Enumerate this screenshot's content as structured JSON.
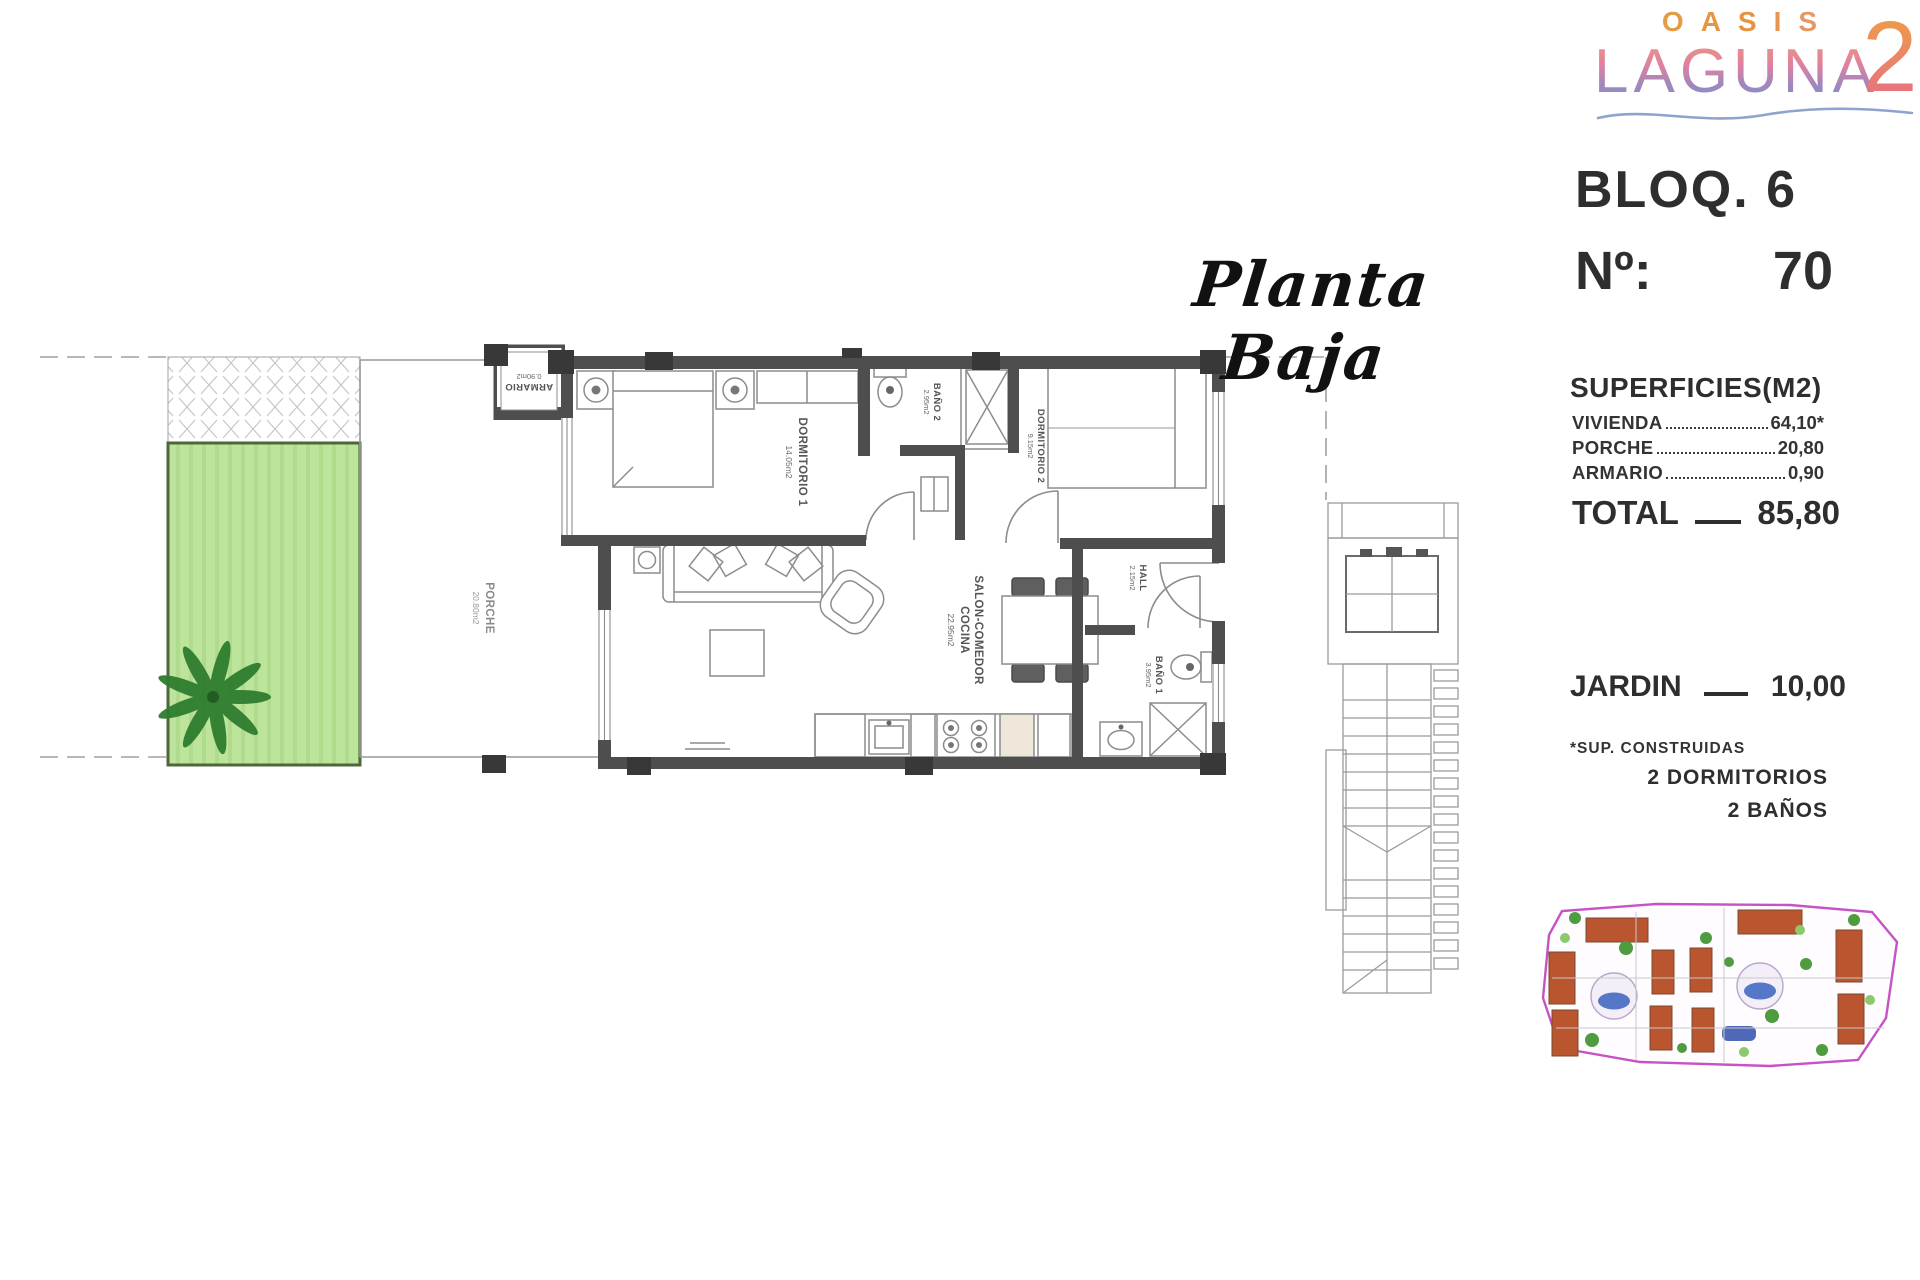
{
  "logo": {
    "brand_top": "OASIS",
    "brand_main": "LAGUNA",
    "brand_numeral": "2"
  },
  "plan_title": "Planta Baja",
  "unit_info": {
    "block": "BLOQ. 6",
    "number_prefix": "Nº:",
    "number": "70"
  },
  "surfaces": {
    "title": "SUPERFICIES(M2)",
    "rows": [
      {
        "label": "VIVIENDA",
        "value": "64,10*"
      },
      {
        "label": "PORCHE",
        "value": "20,80"
      },
      {
        "label": "ARMARIO",
        "value": "0,90"
      }
    ],
    "total_label": "TOTAL",
    "total_value": "85,80",
    "jardin_label": "JARDIN",
    "jardin_value": "10,00",
    "footnote": "*SUP. CONSTRUIDAS",
    "features": [
      "2 DORMITORIOS",
      "2 BAÑOS"
    ]
  },
  "rooms": {
    "dormitorio1": {
      "name": "DORMITORIO 1",
      "area": "14.05m2"
    },
    "bano2": {
      "name": "BAÑO 2",
      "area": "2.95m2"
    },
    "dormitorio2": {
      "name": "DORMITORIO 2",
      "area": "9.15m2"
    },
    "salon": {
      "line1": "SALON-COMEDOR",
      "line2": "COCINA",
      "area": "22.95m2"
    },
    "hall": {
      "name": "HALL",
      "area": "2.15m2"
    },
    "bano1": {
      "name": "BAÑO 1",
      "area": "3.95m2"
    },
    "porche": {
      "name": "PORCHE",
      "area": "20.80m2"
    },
    "armario": {
      "name": "ARMARIO",
      "area": "0.90m2"
    }
  },
  "colors": {
    "wall": "#4e4e4e",
    "column": "#383838",
    "thin_line": "#8c8c8c",
    "garden_fill": "#bce49a",
    "garden_stripe": "#b0da8c",
    "garden_border": "#4e663c",
    "palm_green": "#2f7d2f",
    "site_boundary": "#c653c6",
    "roof_red": "#b9552f",
    "pool_blue": "#5577c7",
    "tree_green": "#4f9b40",
    "logo_orange": "#e2a04b",
    "logo_pink": "#e0809f",
    "logo_blue": "#7b92ca",
    "panel_text": "#2e2e2e"
  }
}
